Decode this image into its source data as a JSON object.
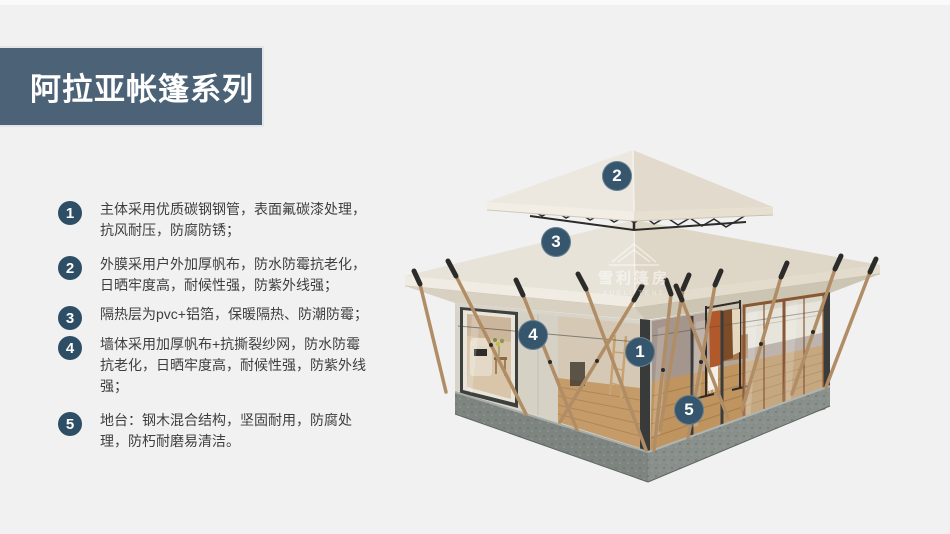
{
  "title": "阿拉亚帐篷系列",
  "features": [
    {
      "num": "1",
      "text": "主体采用优质碳钢钢管，表面氟碳漆处理，抗风耐压，防腐防锈；"
    },
    {
      "num": "2",
      "text": "外膜采用户外加厚帆布，防水防霉抗老化，日晒牢度高，耐候性强，防紫外线强；"
    },
    {
      "num": "3",
      "text": "隔热层为pvc+铝箔，保暖隔热、防潮防霉；"
    },
    {
      "num": "4",
      "text": "墙体采用加厚帆布+抗撕裂纱网，防水防霉抗老化，日晒牢度高，耐候性强，防紫外线强；"
    },
    {
      "num": "5",
      "text": "地台：钢木混合结构，坚固耐用，防腐处理，防朽耐磨易清洁。"
    }
  ],
  "image_markers": [
    "1",
    "2",
    "3",
    "4",
    "5"
  ],
  "watermark": {
    "cn": "雪利篷房",
    "en": "XUELI TENT"
  },
  "colors": {
    "background": "#f1f1f2",
    "banner": "#4c6277",
    "badge": "#2d4e64",
    "marker": "#35566c",
    "title_text": "#ffffff",
    "body_text": "#3e3e3e"
  }
}
